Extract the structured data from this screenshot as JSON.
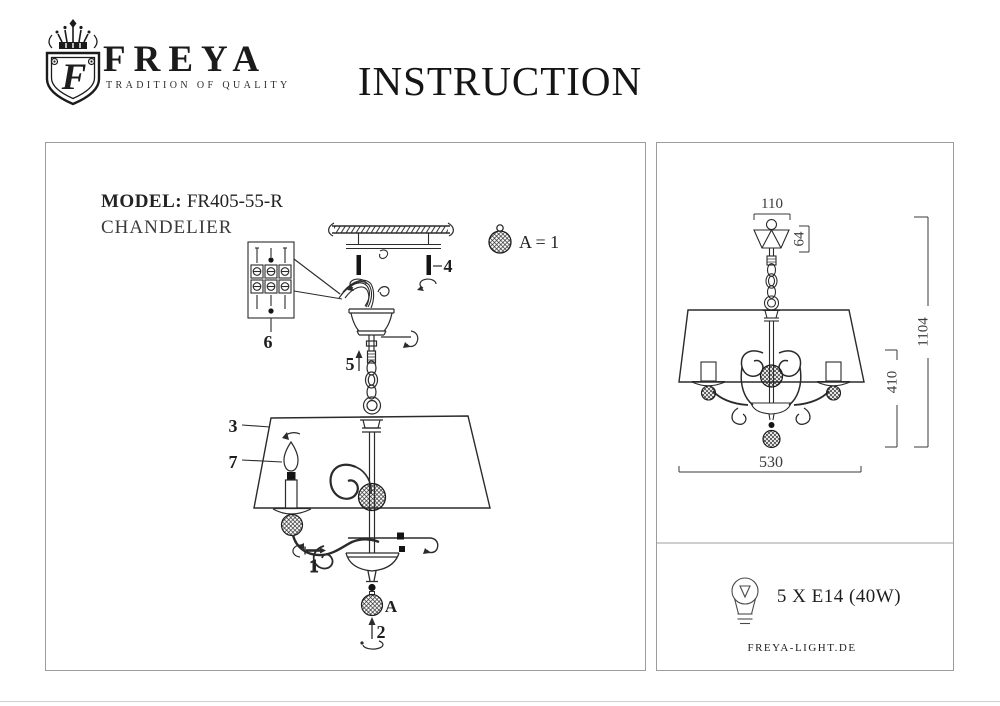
{
  "header": {
    "brand": "FREYA",
    "tagline": "TRADITION OF QUALITY",
    "monogram": "F",
    "title": "INSTRUCTION"
  },
  "left_panel": {
    "model_label": "MODEL:",
    "model_value": "FR405-55-R",
    "product_type": "CHANDELIER",
    "legend_text": "A = 1",
    "crystal_marker": "A",
    "parts": {
      "p1": "1",
      "p2": "2",
      "p3": "3",
      "p4": "4",
      "p5": "5",
      "p6": "6",
      "p7": "7"
    }
  },
  "right_panel": {
    "dims": {
      "canopy_width": "110",
      "canopy_drop": "64",
      "body_height": "410",
      "total_height": "1104",
      "diameter": "530"
    },
    "bulb_spec": "5 X E14 (40W)",
    "website": "FREYA-LIGHT.DE"
  },
  "colors": {
    "ink": "#222222",
    "line": "#2b2b2b",
    "panel_border": "#9c9c9c",
    "muted": "#555555"
  }
}
